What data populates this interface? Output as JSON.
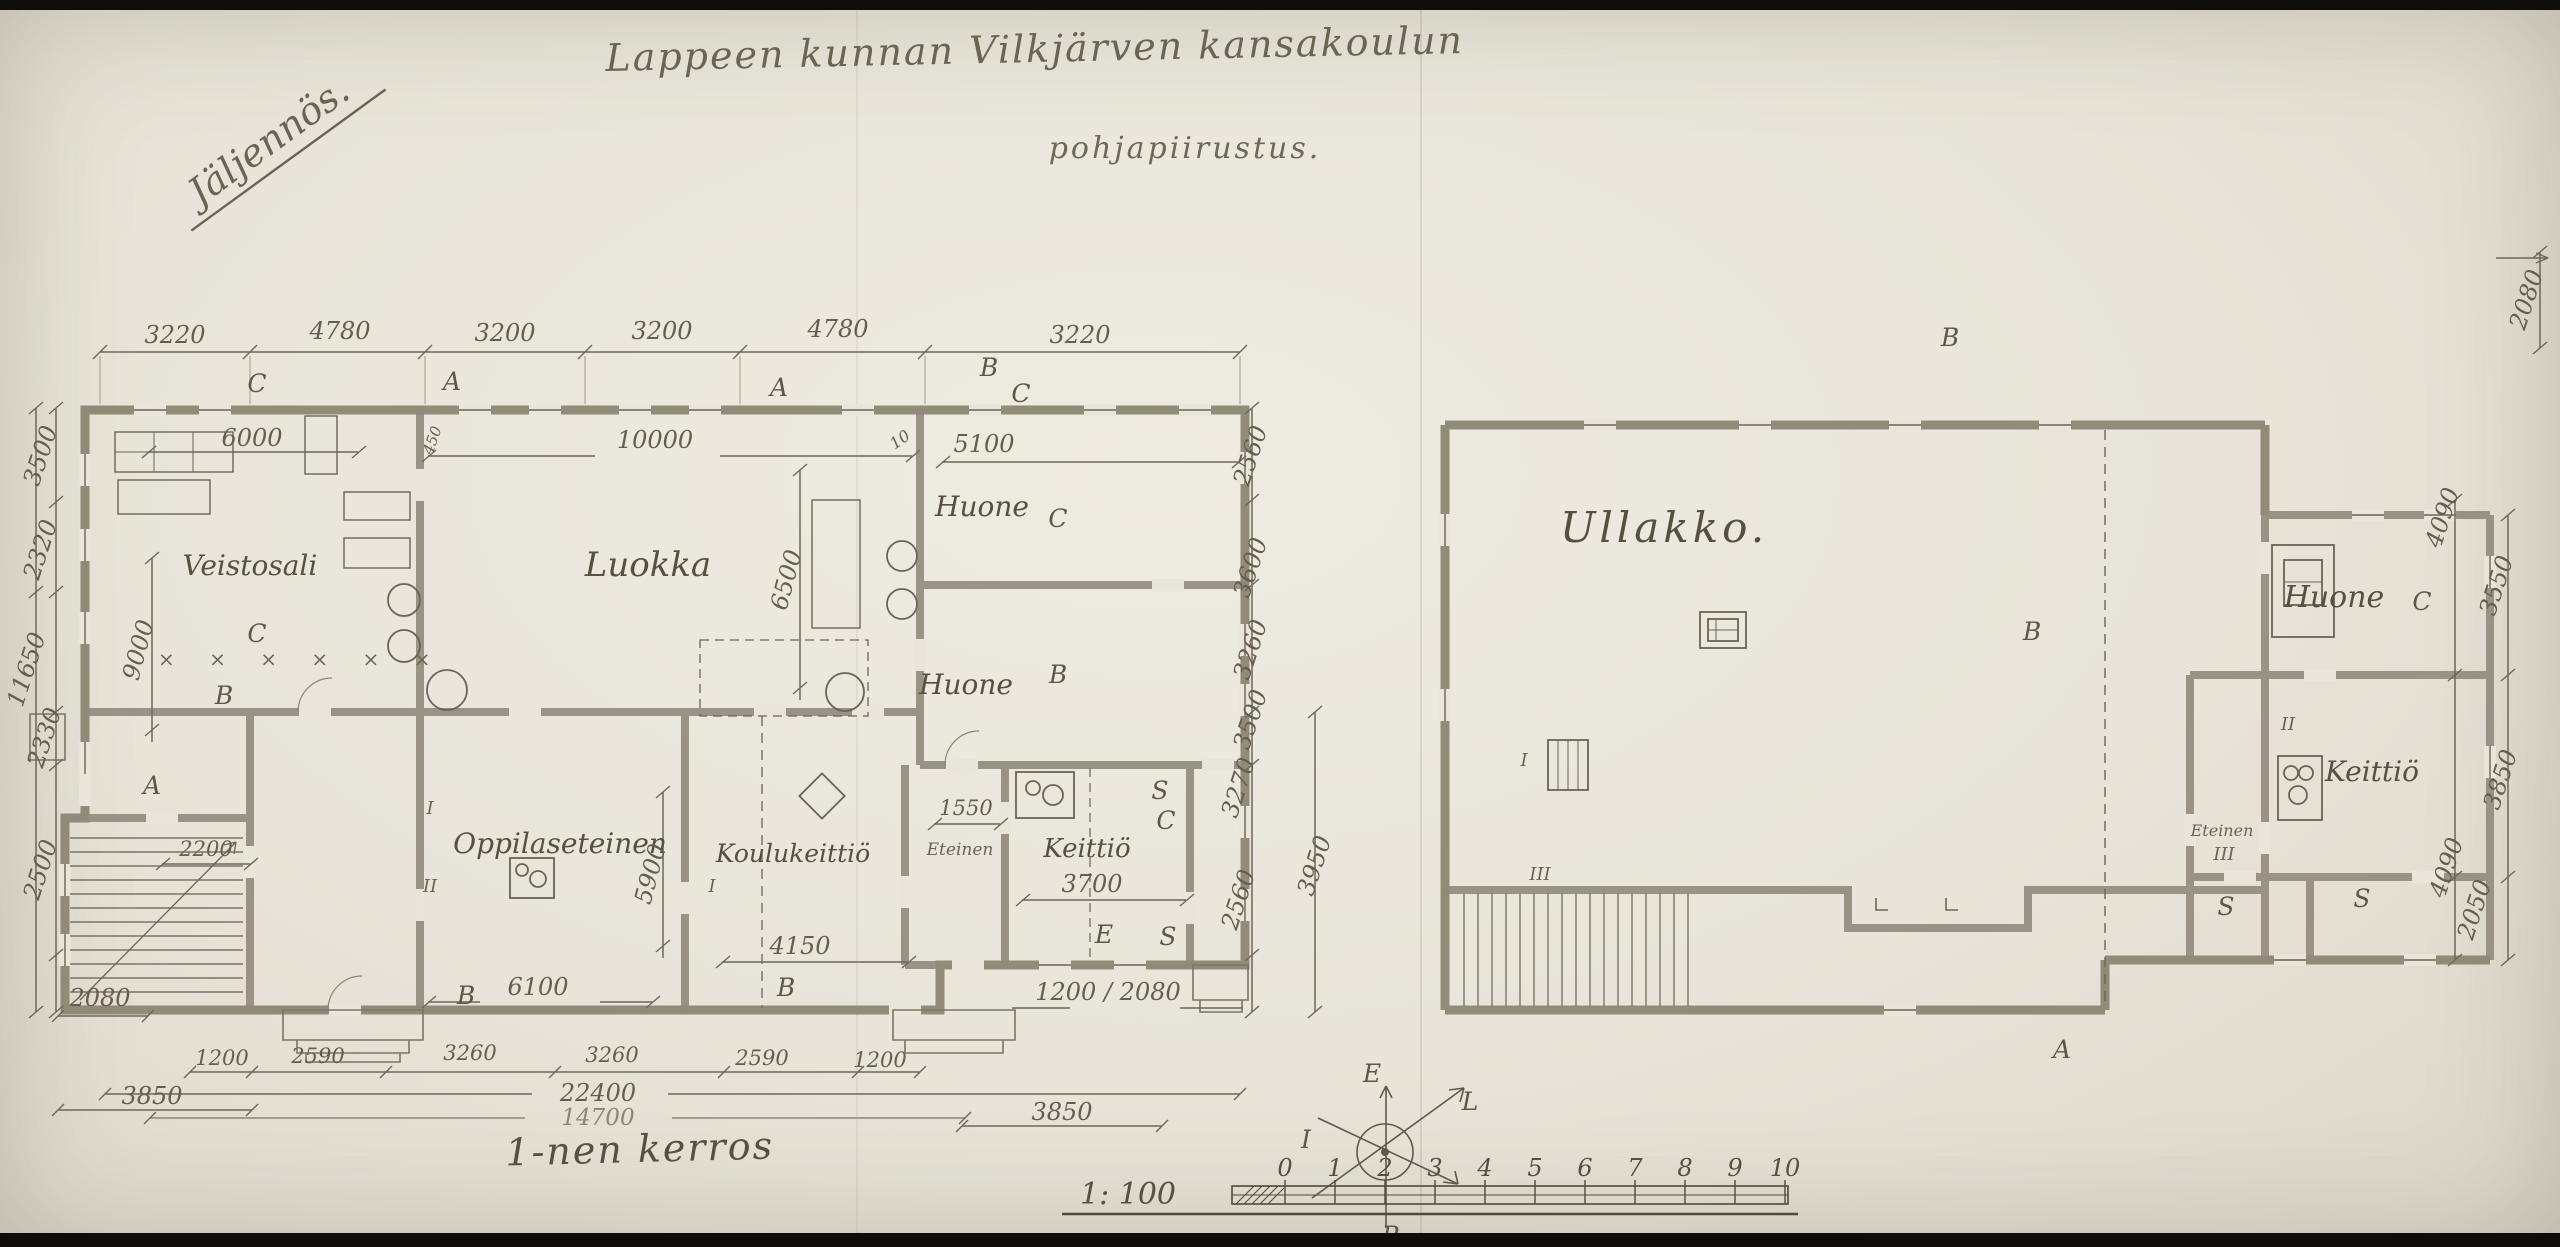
{
  "title": {
    "line1": "Lappeen kunnan Vilkjärven kansakoulun",
    "line2": "pohjapiirustus.",
    "stamp": "Jäljennös."
  },
  "footer": {
    "floor_label": "1-nen kerros",
    "scale_label": "1: 100",
    "scale_ticks": [
      "0",
      "1",
      "2",
      "3",
      "4",
      "5",
      "6",
      "7",
      "8",
      "9",
      "10"
    ]
  },
  "compass": {
    "top": "E",
    "right": "L",
    "bottom": "P",
    "left": "I"
  },
  "colors": {
    "paper": "#e8e4d9",
    "pencil": "#5d5748",
    "wall": "#8f897b"
  },
  "left_plan": {
    "rooms": {
      "veistosali": "Veistosali",
      "luokka": "Luokka",
      "huone_top": "Huone",
      "huone_mid": "Huone",
      "oppilaseteinen": "Oppilaseteinen",
      "koulukeittio": "Koulukeittiö",
      "eteinen": "Eteinen",
      "keittio": "Keittiö"
    },
    "dims_top": [
      "3220",
      "4780",
      "3200",
      "3200",
      "4780",
      "3220"
    ],
    "letters_top": [
      "C",
      "A",
      "A",
      "B",
      "C"
    ],
    "dims_left": [
      "3500",
      "2320",
      "11650",
      "2330",
      "2500",
      "2080"
    ],
    "dims_right": [
      "2560",
      "3600",
      "3260",
      "3500",
      "3270",
      "3950",
      "2560"
    ],
    "dims_inner": {
      "d6000": "6000",
      "d9000": "9000",
      "d10000": "10000",
      "d6500": "6500",
      "d5100": "5100",
      "d450": "450",
      "d10": "10",
      "d5900": "5900",
      "d1550": "1550",
      "d3700": "3700",
      "d2200": "2200",
      "d6100": "6100",
      "d4150": "4150",
      "d_porch": "1200 / 2080"
    },
    "dims_bottom": [
      "1200",
      "2590",
      "3260",
      "3260",
      "2590",
      "1200"
    ],
    "totals": {
      "t22400": "22400",
      "t14700": "14700",
      "left3850": "3850",
      "right3850": "3850"
    },
    "letters": {
      "c_row": "C",
      "x_row": "×  ×  ×  ×  ×  ×",
      "b_veisto": "B",
      "a_hall": "A",
      "c_huone": "C",
      "b_huone": "B",
      "b_bottom1": "B",
      "b_bottom2": "B",
      "e_keittio": "E",
      "s_keittio1": "S",
      "s_keittio2": "S",
      "c_keittio": "C",
      "i_door1": "I",
      "ii_door1": "II",
      "i_door2": "I"
    }
  },
  "right_plan": {
    "rooms": {
      "ullakko": "Ullakko.",
      "huone": "Huone",
      "keittio": "Keittiö",
      "eteinen": "Eteinen"
    },
    "dims_right": [
      "4090",
      "3550",
      "3850",
      "4090",
      "2050"
    ],
    "dim_far_right": "2080",
    "letters": {
      "b_top": "B",
      "b_mid": "B",
      "a_bottom": "A",
      "c_wing": "C",
      "i_stove": "I",
      "iii_stair": "III",
      "ii_wing": "II",
      "iii_wing": "III",
      "s_wing1": "S",
      "s_wing2": "S"
    }
  }
}
